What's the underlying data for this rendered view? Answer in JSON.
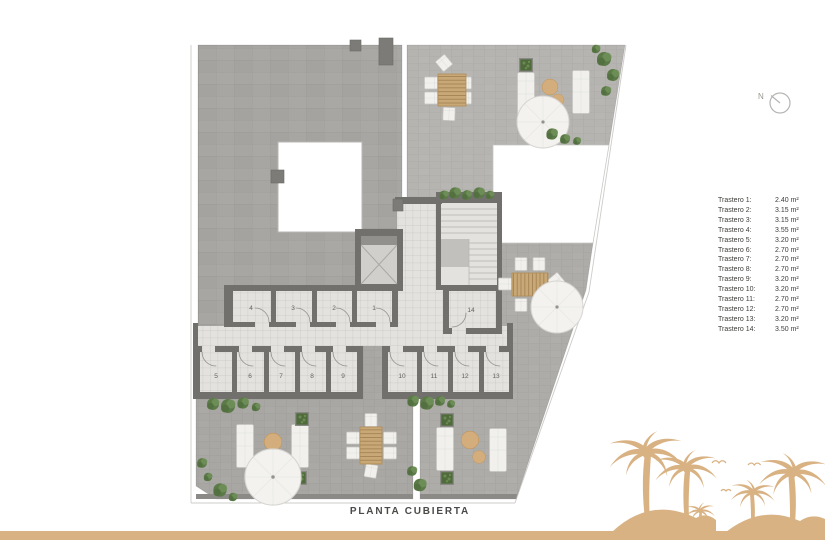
{
  "title": "PLANTA CUBIERTA",
  "compass": {
    "label": "N"
  },
  "legend": {
    "items": [
      {
        "label": "Trastero 1:",
        "area": "2.40 m²"
      },
      {
        "label": "Trastero 2:",
        "area": "3.15 m²"
      },
      {
        "label": "Trastero 3:",
        "area": "3.15 m²"
      },
      {
        "label": "Trastero 4:",
        "area": "3.55 m²"
      },
      {
        "label": "Trastero 5:",
        "area": "3.20 m²"
      },
      {
        "label": "Trastero 6:",
        "area": "2.70 m²"
      },
      {
        "label": "Trastero 7:",
        "area": "2.70 m²"
      },
      {
        "label": "Trastero 8:",
        "area": "2.70 m²"
      },
      {
        "label": "Trastero 9:",
        "area": "3.20 m²"
      },
      {
        "label": "Trastero 10:",
        "area": "3.20 m²"
      },
      {
        "label": "Trastero 11:",
        "area": "2.70 m²"
      },
      {
        "label": "Trastero 12:",
        "area": "2.70 m²"
      },
      {
        "label": "Trastero 13:",
        "area": "3.20 m²"
      },
      {
        "label": "Trastero 14:",
        "area": "3.50 m²"
      }
    ]
  },
  "rooms": [
    {
      "number": "1"
    },
    {
      "number": "2"
    },
    {
      "number": "3"
    },
    {
      "number": "4"
    },
    {
      "number": "5"
    },
    {
      "number": "6"
    },
    {
      "number": "7"
    },
    {
      "number": "8"
    },
    {
      "number": "9"
    },
    {
      "number": "10"
    },
    {
      "number": "11"
    },
    {
      "number": "12"
    },
    {
      "number": "13"
    },
    {
      "number": "14"
    }
  ],
  "colors": {
    "accent_tan": "#d9b284",
    "roof_gray": "#a8a6a2",
    "terrace_gray": "#b1afab",
    "wall_gray": "#71706d",
    "floor_light": "#e3e2df"
  }
}
